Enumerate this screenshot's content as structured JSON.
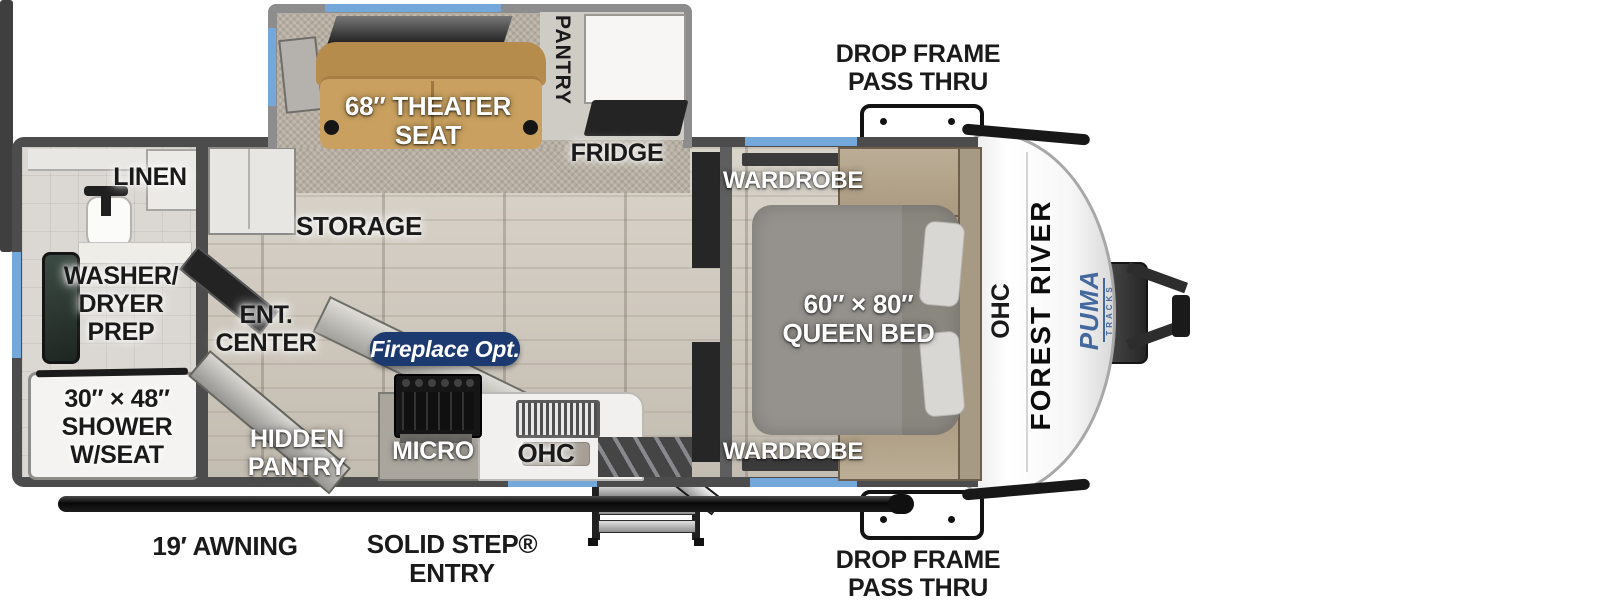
{
  "title": "Forest River Puma travel trailer floor plan",
  "colors": {
    "wall_dark": "#4c4c4c",
    "slide_wall": "#8d8d8d",
    "window_blue": "#74a7da",
    "sofa_tan": "#c9a05f",
    "badge_navy": "#1d3a70",
    "brand_blue": "#44699e",
    "floor_wood": "#cfc8bc"
  },
  "labels": {
    "drop_frame_top": "DROP FRAME\nPASS THRU",
    "drop_frame_bottom": "DROP FRAME\nPASS THRU",
    "awning": "19′ AWNING",
    "solid_step": "SOLID STEP®\nENTRY",
    "theater_seat": "68″ THEATER\nSEAT",
    "pantry": "PANTRY",
    "fridge": "FRIDGE",
    "storage": "STORAGE",
    "linen": "LINEN",
    "washer_dryer": "WASHER/\nDRYER\nPREP",
    "shower": "30″ × 48″\nSHOWER\nW/SEAT",
    "ent_center": "ENT.\nCENTER",
    "fireplace": "Fireplace Opt.",
    "hidden_pantry": "HIDDEN\nPANTRY",
    "micro": "MICRO",
    "ohc_kitchen": "OHC",
    "wardrobe_top": "WARDROBE",
    "wardrobe_bottom": "WARDROBE",
    "queen_bed": "60″ × 80″\nQUEEN BED",
    "ohc_bedroom": "OHC",
    "brand_primary": "FOREST RIVER",
    "brand_model": "PUMA",
    "brand_sub": "TRACKS"
  }
}
